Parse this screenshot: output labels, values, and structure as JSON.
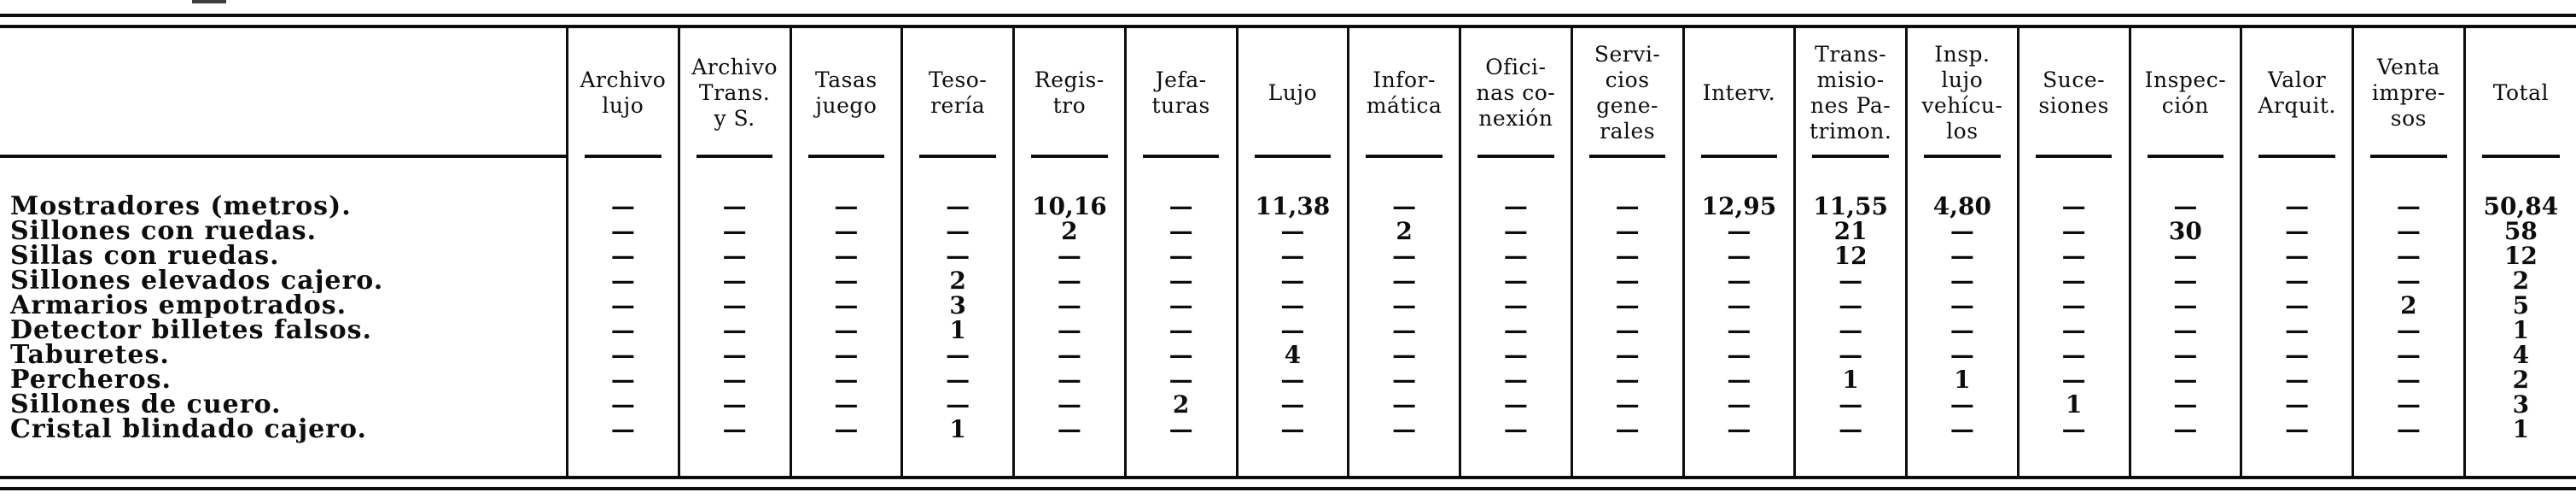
{
  "colors": {
    "ink": "#0d0d0d",
    "paper": "#ffffff"
  },
  "table": {
    "columns": [
      {
        "id": "items",
        "label": ""
      },
      {
        "id": "archivo-lujo",
        "label": "Archivo\nlujo"
      },
      {
        "id": "archivo-trans-y-s",
        "label": "Archivo\nTrans.\ny S."
      },
      {
        "id": "tasas-juego",
        "label": "Tasas\njuego"
      },
      {
        "id": "tesoreria",
        "label": "Teso-\nrería"
      },
      {
        "id": "registro",
        "label": "Regis-\ntro"
      },
      {
        "id": "jefaturas",
        "label": "Jefa-\nturas"
      },
      {
        "id": "lujo",
        "label": "Lujo"
      },
      {
        "id": "informatica",
        "label": "Infor-\nmática"
      },
      {
        "id": "oficinas-conexion",
        "label": "Ofici-\nnas co-\nnexión"
      },
      {
        "id": "servicios-generales",
        "label": "Servi-\ncios\ngene-\nrales"
      },
      {
        "id": "interv",
        "label": "Interv."
      },
      {
        "id": "transmisiones-patrimon",
        "label": "Trans-\nmisio-\nnes Pa-\ntrimon."
      },
      {
        "id": "insp-lujo-vehiculos",
        "label": "Insp.\nlujo\nvehícu-\nlos"
      },
      {
        "id": "sucesiones",
        "label": "Suce-\nsiones"
      },
      {
        "id": "inspeccion",
        "label": "Inspec-\nción"
      },
      {
        "id": "valor-arquit",
        "label": "Valor\nArquit."
      },
      {
        "id": "venta-impresos",
        "label": "Venta\nimpre-\nsos"
      },
      {
        "id": "total",
        "label": "Total"
      }
    ],
    "rows": [
      {
        "label": "Mostradores (metros).",
        "values": [
          "—",
          "—",
          "—",
          "—",
          "10,16",
          "—",
          "11,38",
          "—",
          "—",
          "—",
          "12,95",
          "11,55",
          "4,80",
          "—",
          "—",
          "—",
          "—",
          "50,84"
        ]
      },
      {
        "label": "Sillones con ruedas.",
        "values": [
          "—",
          "—",
          "—",
          "—",
          "2",
          "—",
          "—",
          "2",
          "—",
          "—",
          "—",
          "21",
          "—",
          "—",
          "30",
          "—",
          "—",
          "58"
        ]
      },
      {
        "label": "Sillas con ruedas.",
        "values": [
          "—",
          "—",
          "—",
          "—",
          "—",
          "—",
          "—",
          "—",
          "—",
          "—",
          "—",
          "12",
          "—",
          "—",
          "—",
          "—",
          "—",
          "12"
        ]
      },
      {
        "label": "Sillones elevados cajero.",
        "values": [
          "—",
          "—",
          "—",
          "2",
          "—",
          "—",
          "—",
          "—",
          "—",
          "—",
          "—",
          "—",
          "—",
          "—",
          "—",
          "—",
          "—",
          "2"
        ]
      },
      {
        "label": "Armarios empotrados.",
        "values": [
          "—",
          "—",
          "—",
          "3",
          "—",
          "—",
          "—",
          "—",
          "—",
          "—",
          "—",
          "—",
          "—",
          "—",
          "—",
          "—",
          "2",
          "5"
        ]
      },
      {
        "label": "Detector billetes falsos.",
        "values": [
          "—",
          "—",
          "—",
          "1",
          "—",
          "—",
          "—",
          "—",
          "—",
          "—",
          "—",
          "—",
          "—",
          "—",
          "—",
          "—",
          "—",
          "1"
        ]
      },
      {
        "label": "Taburetes.",
        "values": [
          "—",
          "—",
          "—",
          "—",
          "—",
          "—",
          "4",
          "—",
          "—",
          "—",
          "—",
          "—",
          "—",
          "—",
          "—",
          "—",
          "—",
          "4"
        ]
      },
      {
        "label": "Percheros.",
        "values": [
          "—",
          "—",
          "—",
          "—",
          "—",
          "—",
          "—",
          "—",
          "—",
          "—",
          "—",
          "1",
          "1",
          "—",
          "—",
          "—",
          "—",
          "2"
        ]
      },
      {
        "label": "Sillones de cuero.",
        "values": [
          "—",
          "—",
          "—",
          "—",
          "—",
          "2",
          "—",
          "—",
          "—",
          "—",
          "—",
          "—",
          "—",
          "1",
          "—",
          "—",
          "—",
          "3"
        ]
      },
      {
        "label": "Cristal blindado cajero.",
        "values": [
          "—",
          "—",
          "—",
          "1",
          "—",
          "—",
          "—",
          "—",
          "—",
          "—",
          "—",
          "—",
          "—",
          "—",
          "—",
          "—",
          "—",
          "1"
        ]
      }
    ]
  }
}
